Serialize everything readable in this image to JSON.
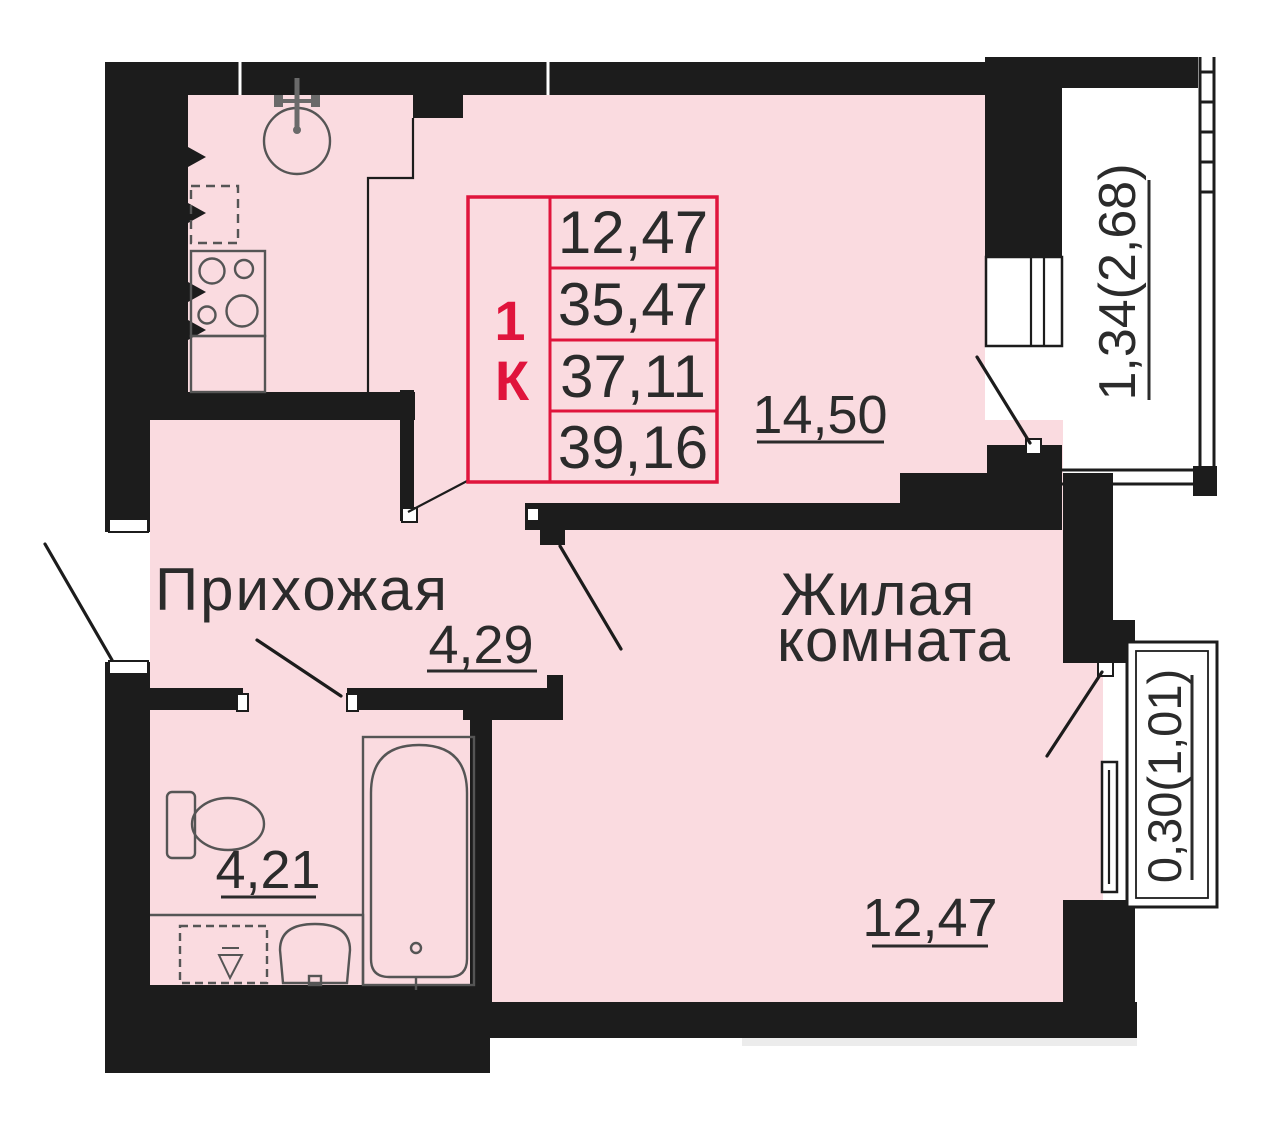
{
  "title": "План квартиры 1К",
  "info_box": {
    "type_lines": [
      "1",
      "К"
    ],
    "values": [
      "12,47",
      "35,47",
      "37,11",
      "39,16"
    ]
  },
  "rooms": {
    "hallway": {
      "name": "Прихожая",
      "area": "4,29"
    },
    "living_room": {
      "name_lines": [
        "Жилая",
        "комната"
      ],
      "area": "12,47"
    },
    "kitchen_living": {
      "area": "14,50"
    },
    "bathroom": {
      "area": "4,21"
    },
    "balcony_large": {
      "area": "1,34(2,68)"
    },
    "balcony_small": {
      "area": "0,30(1,01)"
    }
  },
  "colors": {
    "floor": "#fadbe0",
    "wall": "#1c1c1c",
    "accent": "#e0143c",
    "ink": "#2b2b2b",
    "fixture": "#555555",
    "shadow": "#ececec"
  }
}
